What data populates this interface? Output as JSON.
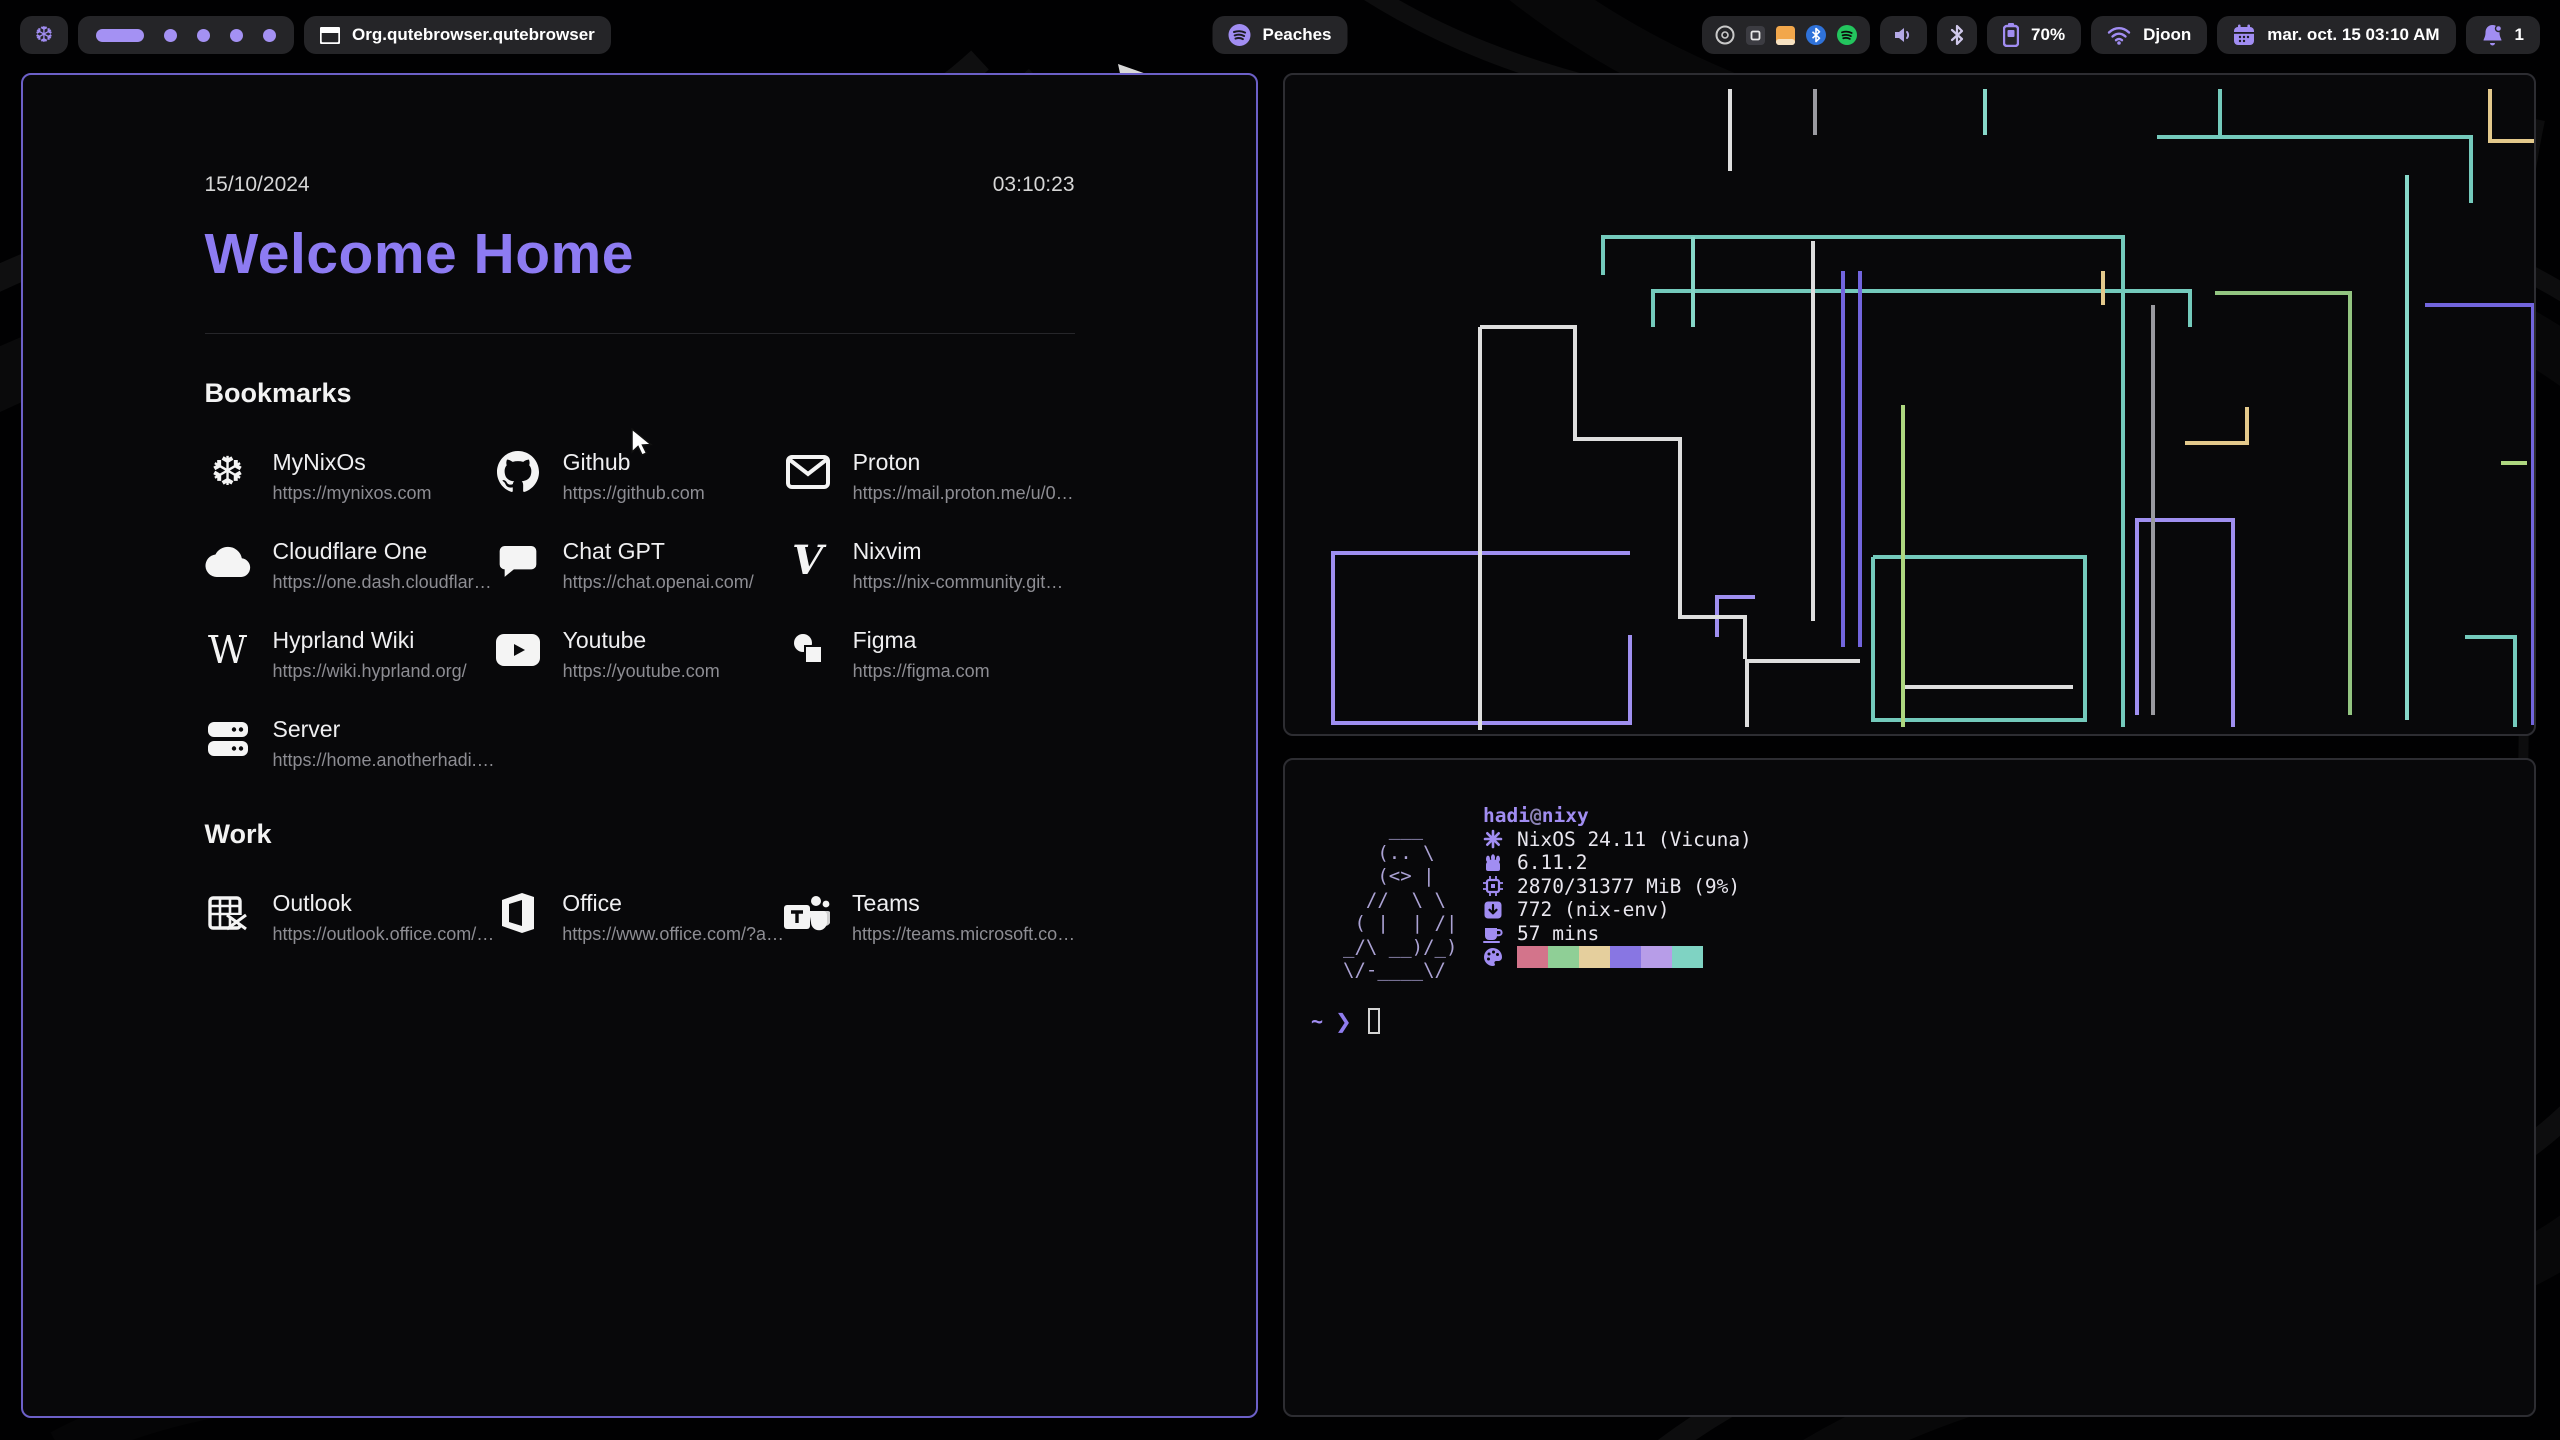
{
  "bar": {
    "logo_icon": "nixos-snowflake",
    "workspaces": {
      "count": 5,
      "active_index": 0
    },
    "window_title": "Org.qutebrowser.qutebrowser",
    "media": {
      "label": "Peaches",
      "icon": "spotify"
    },
    "tray": [
      "disc-icon",
      "app-dark-icon",
      "files-orange-icon",
      "bluetooth-blue-icon",
      "spotify-green-icon"
    ],
    "battery": {
      "percent": "70%"
    },
    "network": {
      "ssid": "Djoon"
    },
    "clock": "mar. oct. 15  03:10 AM",
    "notifications": {
      "count": "1"
    },
    "accent": "#a18df2"
  },
  "browser": {
    "date": "15/10/2024",
    "time": "03:10:23",
    "title": "Welcome Home",
    "title_color": "#8d7bf2",
    "sections": [
      {
        "heading": "Bookmarks",
        "items": [
          {
            "name": "MyNixOs",
            "url": "https://mynixos.com",
            "icon": "nixos"
          },
          {
            "name": "Github",
            "url": "https://github.com",
            "icon": "github"
          },
          {
            "name": "Proton",
            "url": "https://mail.proton.me/u/0…",
            "icon": "mail"
          },
          {
            "name": "Cloudflare One",
            "url": "https://one.dash.cloudflar…",
            "icon": "cloud"
          },
          {
            "name": "Chat GPT",
            "url": "https://chat.openai.com/",
            "icon": "chat"
          },
          {
            "name": "Nixvim",
            "url": "https://nix-community.git…",
            "icon": "vim"
          },
          {
            "name": "Hyprland Wiki",
            "url": "https://wiki.hyprland.org/",
            "icon": "wiki"
          },
          {
            "name": "Youtube",
            "url": "https://youtube.com",
            "icon": "youtube"
          },
          {
            "name": "Figma",
            "url": "https://figma.com",
            "icon": "figma"
          },
          {
            "name": "Server",
            "url": "https://home.anotherhadi.…",
            "icon": "server"
          }
        ]
      },
      {
        "heading": "Work",
        "items": [
          {
            "name": "Outlook",
            "url": "https://outlook.office.com/…",
            "icon": "outlook"
          },
          {
            "name": "Office",
            "url": "https://www.office.com/?a…",
            "icon": "office"
          },
          {
            "name": "Teams",
            "url": "https://teams.microsoft.co…",
            "icon": "teams"
          }
        ]
      }
    ]
  },
  "terminal": {
    "user": "hadi",
    "at": "@",
    "host": "nixy",
    "ascii_art": "    ___\n   (.. \\\n   (<> |\n  //  \\ \\\n ( |  | /|\n_/\\ __)/_)\n\\/-____\\/",
    "info": [
      {
        "icon": "os-icon",
        "text": "NixOS 24.11 (Vicuna)"
      },
      {
        "icon": "kernel-icon",
        "text": "6.11.2"
      },
      {
        "icon": "memory-icon",
        "text": "2870/31377 MiB (9%)"
      },
      {
        "icon": "packages-icon",
        "text": "772 (nix-env)"
      },
      {
        "icon": "uptime-icon",
        "text": "57 mins"
      }
    ],
    "palette": [
      "#d3748b",
      "#8fcf96",
      "#e5cf9d",
      "#8876e3",
      "#b79de8",
      "#7fd3c3"
    ],
    "prompt": {
      "cwd": "~",
      "symbol": "❯"
    }
  },
  "pipes_art_palette": [
    "#74cabc",
    "#86d7c9",
    "#7265dd",
    "#9f8ff0",
    "#dedede",
    "#93c581",
    "#aed780",
    "#e3c98c",
    "#9a9aa0"
  ]
}
